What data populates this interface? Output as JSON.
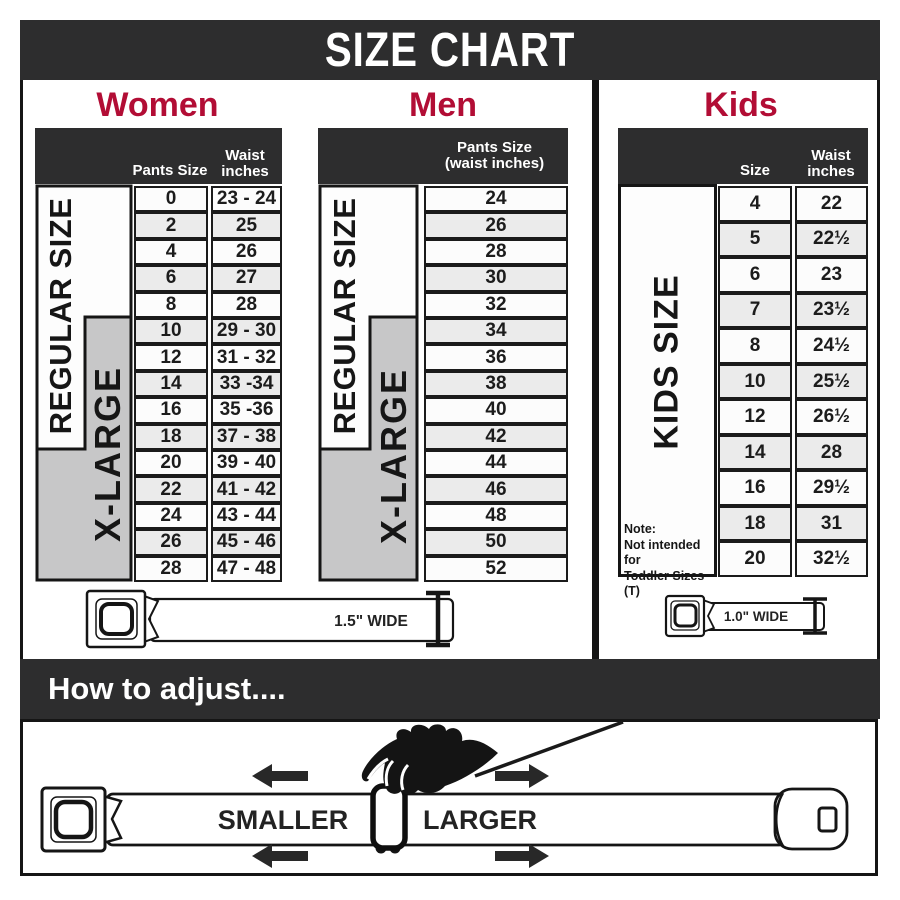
{
  "title": "SIZE CHART",
  "colors": {
    "band_dark": "#2d2d2e",
    "accent_red": "#b20d35",
    "xlarge_gray": "#c7c7c8",
    "row_alt": "#ebebeb",
    "cell_border": "#1b1b1b"
  },
  "women": {
    "title": "Women",
    "header": {
      "col1": "Pants Size",
      "col2_line1": "Waist",
      "col2_line2": "inches"
    },
    "regular_label": "REGULAR SIZE",
    "xlarge_label": "X-LARGE",
    "rows": [
      {
        "size": "0",
        "waist": "23 - 24"
      },
      {
        "size": "2",
        "waist": "25"
      },
      {
        "size": "4",
        "waist": "26"
      },
      {
        "size": "6",
        "waist": "27"
      },
      {
        "size": "8",
        "waist": "28"
      },
      {
        "size": "10",
        "waist": "29 - 30"
      },
      {
        "size": "12",
        "waist": "31 - 32"
      },
      {
        "size": "14",
        "waist": "33 -34"
      },
      {
        "size": "16",
        "waist": "35 -36"
      },
      {
        "size": "18",
        "waist": "37 - 38"
      },
      {
        "size": "20",
        "waist": "39 - 40"
      },
      {
        "size": "22",
        "waist": "41 - 42"
      },
      {
        "size": "24",
        "waist": "43 - 44"
      },
      {
        "size": "26",
        "waist": "45 - 46"
      },
      {
        "size": "28",
        "waist": "47 - 48"
      }
    ]
  },
  "men": {
    "title": "Men",
    "header": {
      "line1": "Pants Size",
      "line2": "(waist inches)"
    },
    "regular_label": "REGULAR SIZE",
    "xlarge_label": "X-LARGE",
    "rows": [
      "24",
      "26",
      "28",
      "30",
      "32",
      "34",
      "36",
      "38",
      "40",
      "42",
      "44",
      "46",
      "48",
      "50",
      "52"
    ]
  },
  "kids": {
    "title": "Kids",
    "header": {
      "col1": "Size",
      "col2_line1": "Waist",
      "col2_line2": "inches"
    },
    "label": "KIDS SIZE",
    "note_line1": "Note:",
    "note_line2": "Not intended for",
    "note_line3": "Toddler Sizes (T)",
    "rows": [
      {
        "size": "4",
        "waist": "22"
      },
      {
        "size": "5",
        "waist": "22½"
      },
      {
        "size": "6",
        "waist": "23"
      },
      {
        "size": "7",
        "waist": "23½"
      },
      {
        "size": "8",
        "waist": "24½"
      },
      {
        "size": "10",
        "waist": "25½"
      },
      {
        "size": "12",
        "waist": "26½"
      },
      {
        "size": "14",
        "waist": "28"
      },
      {
        "size": "16",
        "waist": "29½"
      },
      {
        "size": "18",
        "waist": "31"
      },
      {
        "size": "20",
        "waist": "32½"
      }
    ]
  },
  "belts": {
    "adult_width_label": "1.5\" WIDE",
    "kids_width_label": "1.0\" WIDE"
  },
  "adjust": {
    "heading": "How to adjust....",
    "smaller_label": "SMALLER",
    "larger_label": "LARGER"
  }
}
